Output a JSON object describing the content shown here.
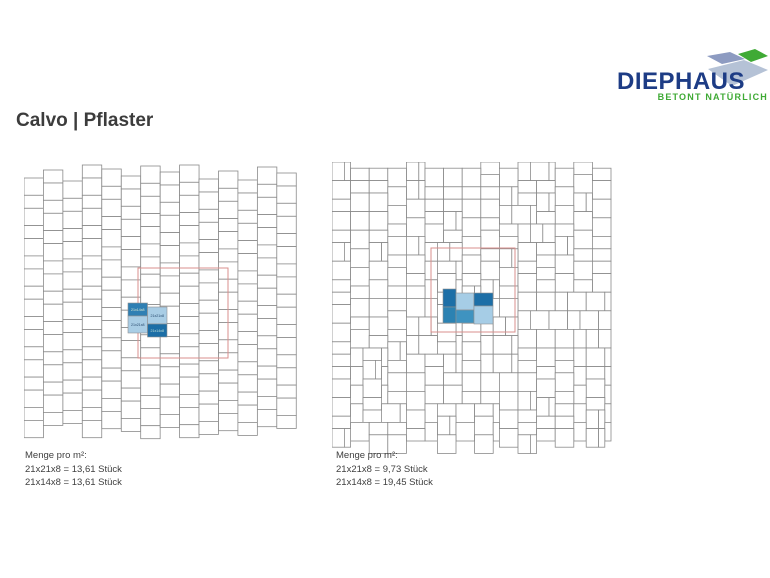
{
  "title": "Calvo | Pflaster",
  "logo": {
    "brand": "DIEPHAUS",
    "tagline": "BETONT NATÜRLICH",
    "brand_color": "#1d3c85",
    "tagline_color": "#3faa35",
    "shape_colors": {
      "slab": "#b5c2d6",
      "stone_blue": "#8d9bc1",
      "stone_green": "#3faa35"
    }
  },
  "colors": {
    "page_bg": "#ffffff",
    "title_text": "#3c3c3c",
    "caption_text": "#3f3f3f",
    "grid_line": "#8a8a8a",
    "red_reference": "#d98f8c",
    "tile_dark_blue": "#1d6fa7",
    "tile_medium_blue": "#3f93c0",
    "tile_light_blue": "#a6cde6"
  },
  "diagrams": [
    {
      "id": "left",
      "type": "row-bond",
      "width": 272,
      "height": 274,
      "col_width": 19.45,
      "cell_heights": [
        17.3,
        13.0
      ],
      "col_offsets": [
        15,
        7,
        18,
        2,
        6,
        13,
        3,
        9,
        2,
        16,
        8,
        17,
        4,
        10
      ],
      "grid_color": "#8a8a8a",
      "red_square": {
        "x": 114,
        "y": 105,
        "size": 90,
        "color": "#d98f8c"
      },
      "highlight": [
        {
          "x": 104,
          "y": 140,
          "w": 19.5,
          "h": 13,
          "color": "#2f7fb3",
          "label": "21x14x8",
          "text_color": "#dcead2"
        },
        {
          "x": 123.5,
          "y": 144,
          "w": 19.5,
          "h": 17,
          "color": "#a9cde5",
          "label": "21x21x8",
          "text_color": "#27496d"
        },
        {
          "x": 104,
          "y": 153,
          "w": 19.5,
          "h": 17,
          "color": "#a9cde5",
          "label": "21x21x8",
          "text_color": "#27496d"
        },
        {
          "x": 123.5,
          "y": 161,
          "w": 19.5,
          "h": 13,
          "color": "#1c6ea6",
          "label": "21x14x8",
          "text_color": "#bfe0d8"
        }
      ],
      "caption": {
        "heading": "Menge pro m²:",
        "lines": [
          "21x21x8 = 13,61 Stück",
          "21x14x8 = 13,61 Stück"
        ]
      }
    },
    {
      "id": "right",
      "type": "wild-bond",
      "width": 276,
      "height": 278,
      "unit": 6.2,
      "seed": 9,
      "grid_color": "#8a8a8a",
      "red_square": {
        "x": 99,
        "y": 86,
        "size": 84,
        "color": "#d98f8c"
      },
      "highlight": [
        {
          "x": 111,
          "y": 127,
          "w": 13,
          "h": 18,
          "color": "#1d6fa7",
          "label": "",
          "text_color": "#ffffff"
        },
        {
          "x": 111,
          "y": 145,
          "w": 13,
          "h": 16,
          "color": "#2c82b2",
          "label": "",
          "text_color": "#ffffff"
        },
        {
          "x": 124,
          "y": 131,
          "w": 18,
          "h": 17,
          "color": "#a6cde6",
          "label": "",
          "text_color": "#27496d"
        },
        {
          "x": 124,
          "y": 148,
          "w": 18,
          "h": 13,
          "color": "#3f93c0",
          "label": "",
          "text_color": "#ffffff"
        },
        {
          "x": 142,
          "y": 131,
          "w": 19,
          "h": 13,
          "color": "#1d6fa7",
          "label": "",
          "text_color": "#ffffff"
        },
        {
          "x": 142,
          "y": 144,
          "w": 19,
          "h": 18,
          "color": "#a6cde6",
          "label": "",
          "text_color": "#27496d"
        }
      ],
      "caption": {
        "heading": "Menge pro m²:",
        "lines": [
          "21x21x8 = 9,73 Stück",
          "21x14x8 = 19,45 Stück"
        ]
      }
    }
  ]
}
